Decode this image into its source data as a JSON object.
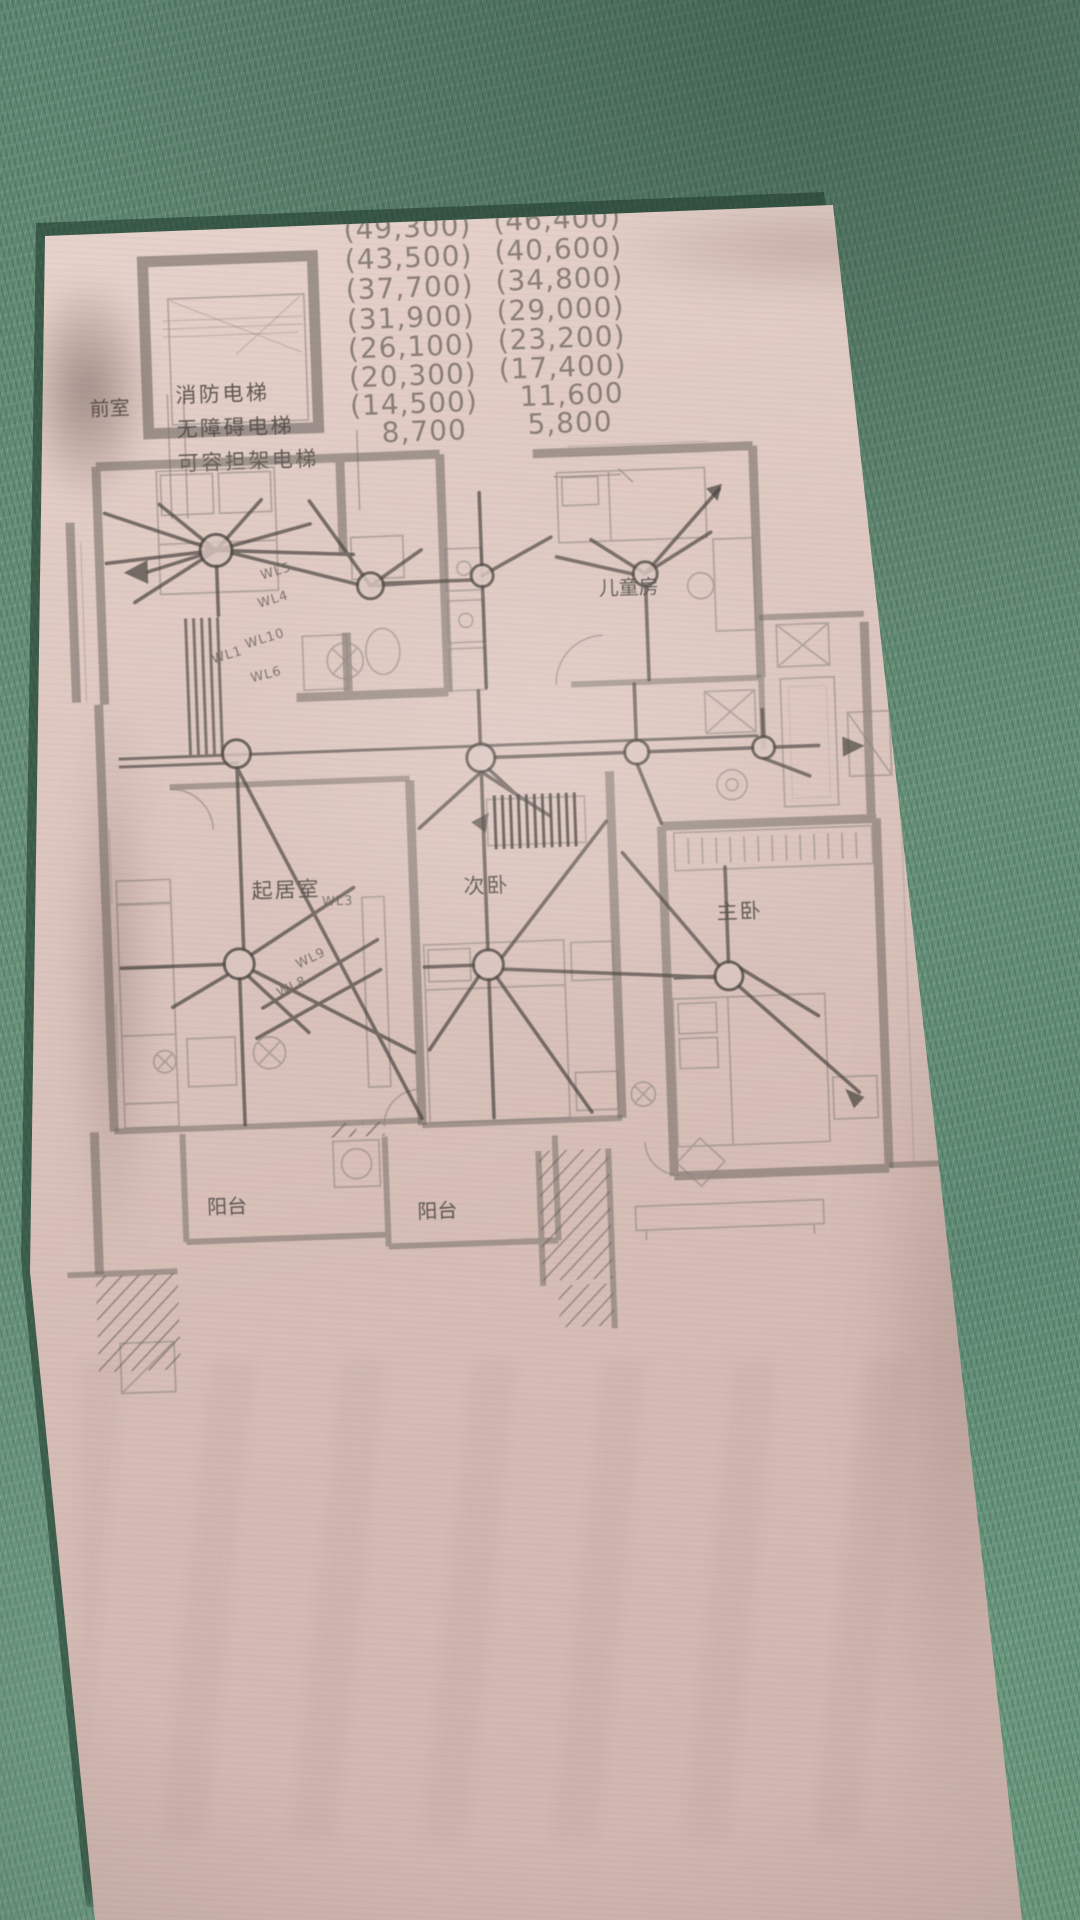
{
  "levels_table": {
    "rows": [
      {
        "left": "(49,300)",
        "right": "(46,400)"
      },
      {
        "left": "(43,500)",
        "right": "(40,600)"
      },
      {
        "left": "(37,700)",
        "right": "(34,800)"
      },
      {
        "left": "(31,900)",
        "right": "(29,000)"
      },
      {
        "left": "(26,100)",
        "right": "(23,200)"
      },
      {
        "left": "(20,300)",
        "right": "(17,400)"
      },
      {
        "left": "(14,500)",
        "right": "11,600"
      },
      {
        "left": "8,700",
        "right": "5,800"
      }
    ]
  },
  "elevator_box": {
    "line1": "消防电梯",
    "line2": "无障碍电梯",
    "line3": "可容担架电梯"
  },
  "room_labels": {
    "vestibule": "前室",
    "children_room": "儿童房",
    "living_room": "起居室",
    "second_bedroom": "次卧",
    "master_bedroom": "主卧",
    "balcony_left": "阳台",
    "balcony_center": "阳台"
  },
  "circuit_labels": {
    "wl1": "WL1",
    "wl3": "WL3",
    "wl4": "WL4",
    "wl5": "WL5",
    "wl6": "WL6",
    "wl8": "WL8",
    "wl9": "WL9",
    "wl10": "WL10"
  },
  "colors": {
    "carpet_green": "#618a74",
    "paper_pink": "#dcc6bf",
    "ink_gray": "#5a534d",
    "wall_gray": "#6f6761"
  }
}
